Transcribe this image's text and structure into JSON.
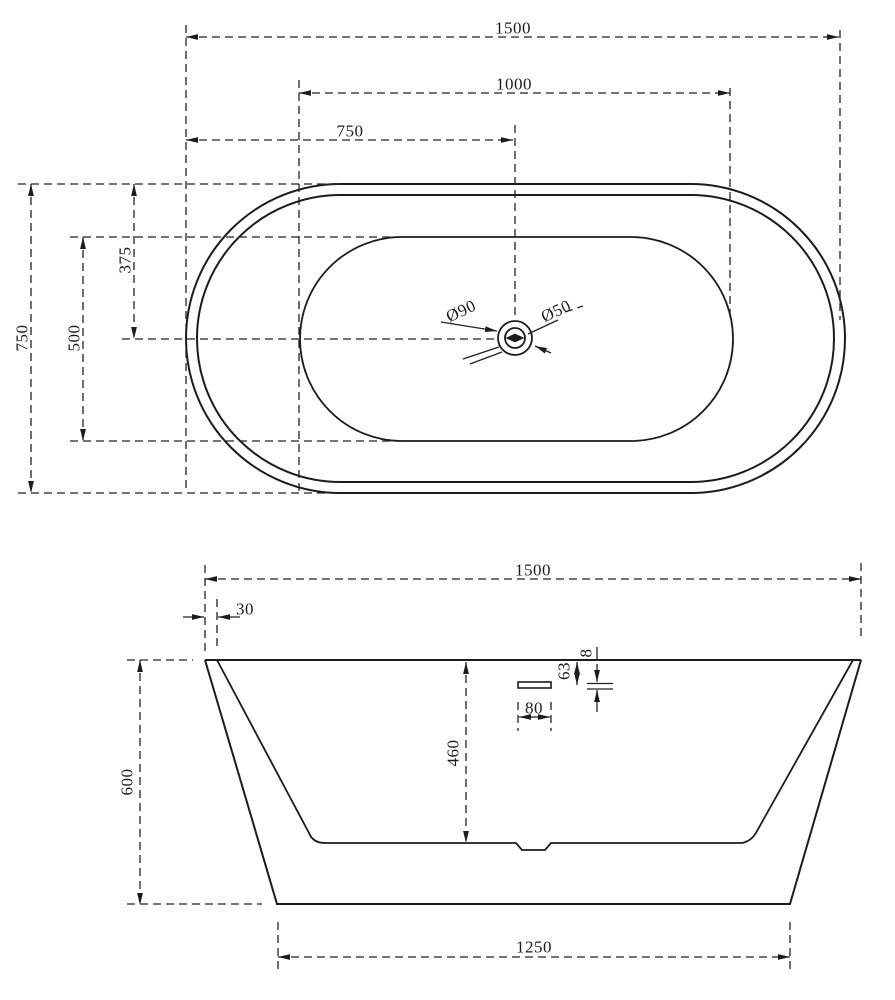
{
  "colors": {
    "line": "#1c1c1c",
    "background": "#ffffff"
  },
  "top_view": {
    "dim_length": "1500",
    "dim_inner_length": "1000",
    "dim_half_length": "750",
    "dim_width": "750",
    "dim_inner_width": "500",
    "dim_half_width": "375",
    "dim_drain_outer": "Ø90",
    "dim_drain_inner": "Ø50"
  },
  "side_view": {
    "dim_length": "1500",
    "dim_rim_offset": "30",
    "dim_height": "600",
    "dim_inner_depth": "460",
    "dim_overflow_width": "80",
    "dim_overflow_offset": "63",
    "dim_overflow_height": "8",
    "dim_base_length": "1250"
  }
}
